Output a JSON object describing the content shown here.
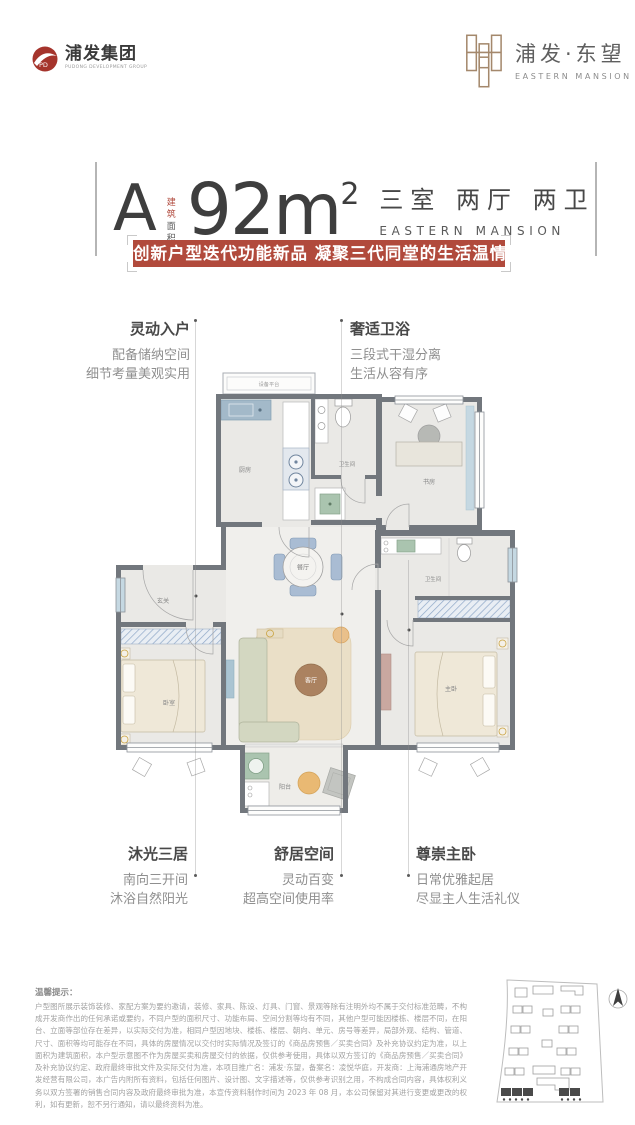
{
  "header": {
    "group_logo": {
      "title": "浦发集团",
      "subtitle": "PUDONG DEVELOPMENT GROUP"
    },
    "brand_logo": {
      "title": "浦发·东望",
      "subtitle": "EASTERN MANSION"
    }
  },
  "title_block": {
    "unit_label": "A",
    "area_note_top": "建 筑",
    "area_note_bottom": "面积约",
    "area_value": "92m",
    "area_superscript": "2",
    "layout_text": "三室 两厅 两卫",
    "layout_subtext": "EASTERN MANSION"
  },
  "banner": {
    "text": "创新户型迭代功能新品 凝聚三代同堂的生活温情"
  },
  "callouts": {
    "entry": {
      "title": "灵动入户",
      "line1": "配备储纳空间",
      "line2": "细节考量美观实用"
    },
    "bath": {
      "title": "奢适卫浴",
      "line1": "三段式干湿分离",
      "line2": "生活从容有序"
    },
    "light": {
      "title": "沐光三居",
      "line1": "南向三开间",
      "line2": "沐浴自然阳光"
    },
    "space": {
      "title": "舒居空间",
      "line1": "灵动百变",
      "line2": "超高空间使用率"
    },
    "master": {
      "title": "尊崇主卧",
      "line1": "日常优雅起居",
      "line2": "尽显主人生活礼仪"
    }
  },
  "floorplan": {
    "rooms": {
      "equipment_platform": "设备平台",
      "kitchen": "厨房",
      "bathroom_1": "卫生间",
      "study": "书房",
      "dining": "餐厅",
      "foyer": "玄关",
      "bathroom_2": "卫生间",
      "bedroom": "卧室",
      "living": "客厅",
      "master_bedroom": "主卧",
      "balcony": "阳台"
    }
  },
  "disclaimer": {
    "title": "温馨提示：",
    "body": "户型图所展示装饰装修、家配方案为要约邀请，装修、家具、陈设、灯具、门窗、景观等除有注明外均不属于交付标准范畴，不构成开发商作出的任何承诺或要约，不同户型的面积尺寸、功能布局、空间分割等均有不同，其他户型可能因楼栋、楼层不同，在阳台、立面等部位存在差异，以实际交付为准，相同户型因地块、楼栋、楼层、朝向、单元、房号等差异，局部外观、结构、管道、尺寸、面积等均可能存在不同，具体的房屋情况以交付时实际情况及签订的《商品房预售／买卖合同》及补充协议约定为准，以上面积为建筑面积，本户型示意图不作为房屋买卖和房屋交付的依据，仅供参考使用，具体以双方签订的《商品房预售／买卖合同》及补充协议约定、政府最终审批文件及实际交付为准，本项目推广名：浦发·东望，备案名：凌悦华庭，开发商：上海浦通房地产开发经营有限公司，本广告内附所有资料，包括任何图片、设计图、文字描述等，仅供参考识别之用，不构成合同内容，具体权利义务以双方签署的销售合同内容及政府最终审批为准，本宣传资料制作时间为 2023 年 08 月，本公司保留对其进行变更或更改的权利，如有更新，恕不另行通知，请以最终资料为准。"
  },
  "colors": {
    "accent_red": "#b14a3c",
    "logo_red": "#a5342c",
    "bronze": "#a4886c",
    "wall_gray": "#72777d"
  }
}
